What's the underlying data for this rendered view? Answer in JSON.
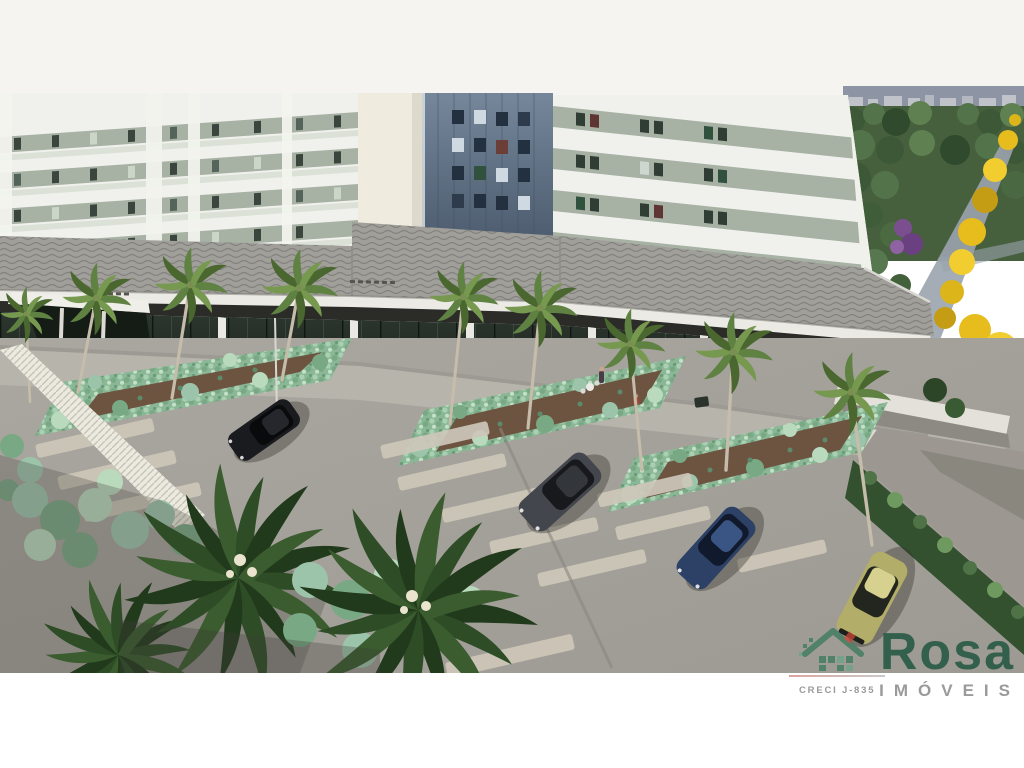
{
  "watermark": {
    "brand": "Rosa",
    "brand_type": "IMÓVEIS",
    "license": "CRECI J-835",
    "brand_color": "#245843",
    "text_gray": "#9a9a9a"
  },
  "palette": {
    "sky": "#f5f4f1",
    "building_white": "#f0f1ec",
    "building_sage": "#a7b1a4",
    "glass_tower": "#5c6e83",
    "roof_gray": "#a09f9a",
    "storefront_glass": "#1a221c",
    "pavement": "#a6a39c",
    "sidewalk": "#b7b4ac",
    "stall_stripe": "#cdc7b8",
    "shrub_green": "#9cc4ab",
    "mulch_brown": "#6d5440",
    "palm_green": "#5d7d44",
    "dark_palm_green": "#2b4423",
    "ipe_yellow": "#e7bd1d",
    "ipe_purple": "#7b4f8f",
    "forest_green": "#46603e",
    "hedge_green": "#33502f"
  },
  "cars": [
    {
      "name": "car-black",
      "color": "#1a1b1f"
    },
    {
      "name": "car-graphite",
      "color": "#43464c"
    },
    {
      "name": "car-navy",
      "color": "#2c4165"
    },
    {
      "name": "car-olive",
      "color": "#b2ad68"
    }
  ],
  "scene": {
    "description_labels": {
      "left_tower": "residential tower with balconies",
      "right_tower": "striped residential tower",
      "center": "glass elevator core",
      "canopy": "commercial canopy roof with storefronts",
      "grounds": "parking lot with garden beds and royal palms"
    }
  }
}
